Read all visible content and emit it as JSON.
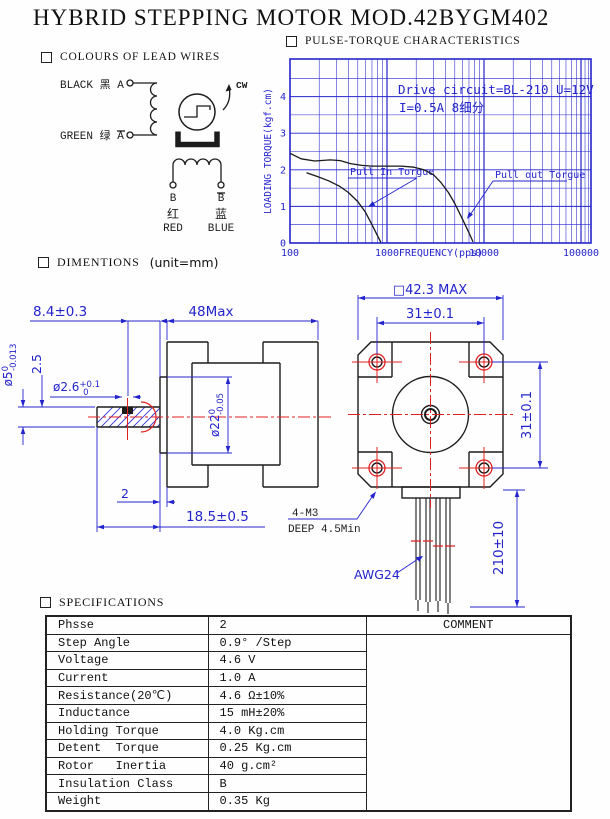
{
  "title": "HYBRID STEPPING MOTOR MOD.42BYGM402",
  "sections": {
    "lead_wires": {
      "label": "COLOURS OF LEAD WIRES"
    },
    "pulse_torque": {
      "label": "PULSE-TORQUE CHARACTERISTICS"
    },
    "dimensions": {
      "label": "DIMENTIONS",
      "unit_note": "(unit=mm)"
    },
    "specifications": {
      "label": "SPECIFICATIONS"
    }
  },
  "wiring": {
    "phase_a_top": "BLACK 黑 A",
    "phase_a_bottom": "GREEN 绿 A",
    "rotation": "CW",
    "terminal_b_left": "B",
    "terminal_b_right": "B",
    "red_cn": "红",
    "red_en": "RED",
    "blue_cn": "蓝",
    "blue_en": "BLUE"
  },
  "chart_data": {
    "type": "line",
    "title": "PULSE-TORQUE CHARACTERISTICS",
    "xlabel": "FREQUENCY(pps)",
    "ylabel": "LOADING TORQUE(kgf.cm)",
    "x_scale": "log",
    "xlim": [
      100,
      124000
    ],
    "ylim": [
      0,
      5
    ],
    "x_ticks": [
      100,
      1000,
      10000,
      100000
    ],
    "y_ticks": [
      0,
      1,
      2,
      3,
      4
    ],
    "y_grid_step": 0.5,
    "grid": true,
    "annotation": [
      "Drive circuit=BL-210 U=12V",
      "I=0.5A  8细分"
    ],
    "colors": {
      "grid": "#2424cd",
      "curve": "#1a1a1a",
      "text": "#2424cd"
    },
    "series": [
      {
        "name": "Pull In Torgue",
        "points": [
          [
            148,
            1.92
          ],
          [
            190,
            1.82
          ],
          [
            250,
            1.7
          ],
          [
            320,
            1.56
          ],
          [
            400,
            1.38
          ],
          [
            500,
            1.13
          ],
          [
            600,
            0.84
          ],
          [
            700,
            0.5
          ],
          [
            790,
            0.22
          ],
          [
            865,
            0.02
          ]
        ]
      },
      {
        "name": "Pull out Torgue",
        "points": [
          [
            100,
            2.45
          ],
          [
            130,
            2.3
          ],
          [
            180,
            2.24
          ],
          [
            260,
            2.27
          ],
          [
            330,
            2.25
          ],
          [
            420,
            2.17
          ],
          [
            550,
            2.12
          ],
          [
            700,
            2.1
          ],
          [
            1000,
            2.1
          ],
          [
            1400,
            2.1
          ],
          [
            1900,
            2.07
          ],
          [
            2400,
            2.0
          ],
          [
            3000,
            1.87
          ],
          [
            3600,
            1.65
          ],
          [
            4300,
            1.38
          ],
          [
            5000,
            1.08
          ],
          [
            6000,
            0.65
          ],
          [
            7000,
            0.28
          ],
          [
            7700,
            0.03
          ]
        ]
      }
    ]
  },
  "dims": {
    "top_left": "8.4±0.3",
    "body_len": "48Max",
    "shaft_dia": {
      "main": "ø5",
      "sup": "0",
      "sub": "-0.013"
    },
    "flat_height": "2.5",
    "hole_dia": {
      "main": "ø2.6",
      "sup": "+0.1",
      "sub": "0"
    },
    "boss_dia": {
      "main": "ø22",
      "sup": "0",
      "sub": "-0.05"
    },
    "boss_height": "2",
    "shaft_len": "18.5±0.5",
    "face_size": "□42.3 MAX",
    "hole_pitch_h": "31±0.1",
    "hole_pitch_v": "31±0.1",
    "lead_len": "210±10",
    "mount_line1": "4-M3",
    "mount_line2": "DEEP 4.5Min",
    "wire_gauge": "AWG24"
  },
  "specs": {
    "comment_header": "COMMENT",
    "rows": [
      {
        "label": "Phsse",
        "value": "2"
      },
      {
        "label": "Step Angle",
        "value": "0.9° /Step"
      },
      {
        "label": "Voltage",
        "value": "4.6 V"
      },
      {
        "label": "Current",
        "value": "1.0 A"
      },
      {
        "label": "Resistance(20℃)",
        "value": "4.6 Ω±10%"
      },
      {
        "label": "Inductance",
        "value": "15 mH±20%"
      },
      {
        "label": "Holding Torque",
        "value": "4.0 Kg.cm"
      },
      {
        "label": "Detent  Torque",
        "value": "0.25 Kg.cm"
      },
      {
        "label": "Rotor   Inertia",
        "value": "40 g.cm²"
      },
      {
        "label": "Insulation Class",
        "value": "B"
      },
      {
        "label": "Weight",
        "value": "0.35 Kg"
      }
    ]
  }
}
